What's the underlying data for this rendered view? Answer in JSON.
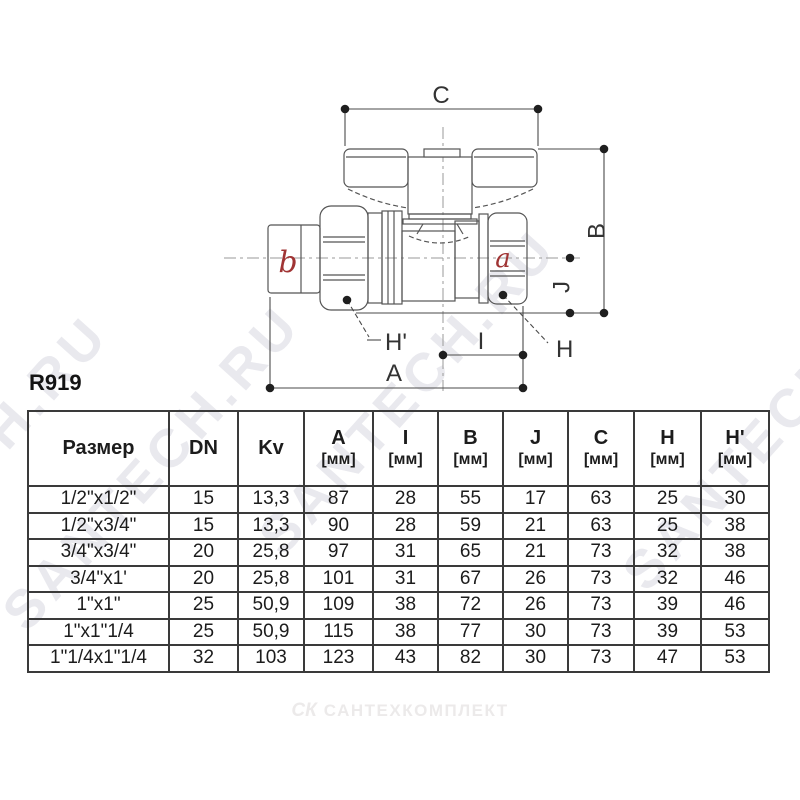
{
  "product_code": "R919",
  "diagram": {
    "dimension_labels": {
      "C": "C",
      "B": "B",
      "J": "J",
      "H": "H",
      "H_prime": "H'",
      "A": "A",
      "I": "I"
    },
    "port_labels": {
      "a": "a",
      "b": "b"
    },
    "colors": {
      "port_label": "#a03434",
      "line": "#4a4a4a",
      "dot": "#1f1f1f"
    }
  },
  "table": {
    "headers": [
      {
        "label": "Размер",
        "unit": ""
      },
      {
        "label": "DN",
        "unit": ""
      },
      {
        "label": "Kv",
        "unit": ""
      },
      {
        "label": "A",
        "unit": "[мм]"
      },
      {
        "label": "I",
        "unit": "[мм]"
      },
      {
        "label": "B",
        "unit": "[мм]"
      },
      {
        "label": "J",
        "unit": "[мм]"
      },
      {
        "label": "C",
        "unit": "[мм]"
      },
      {
        "label": "H",
        "unit": "[мм]"
      },
      {
        "label": "H'",
        "unit": "[мм]"
      }
    ],
    "rows": [
      [
        "1/2\"x1/2\"",
        "15",
        "13,3",
        "87",
        "28",
        "55",
        "17",
        "63",
        "25",
        "30"
      ],
      [
        "1/2\"x3/4\"",
        "15",
        "13,3",
        "90",
        "28",
        "59",
        "21",
        "63",
        "25",
        "38"
      ],
      [
        "3/4\"x3/4\"",
        "20",
        "25,8",
        "97",
        "31",
        "65",
        "21",
        "73",
        "32",
        "38"
      ],
      [
        "3/4\"x1'",
        "20",
        "25,8",
        "101",
        "31",
        "67",
        "26",
        "73",
        "32",
        "46"
      ],
      [
        "1\"x1\"",
        "25",
        "50,9",
        "109",
        "38",
        "72",
        "26",
        "73",
        "39",
        "46"
      ],
      [
        "1\"x1\"1/4",
        "25",
        "50,9",
        "115",
        "38",
        "77",
        "30",
        "73",
        "39",
        "53"
      ],
      [
        "1\"1/4x1\"1/4",
        "32",
        "103",
        "123",
        "43",
        "82",
        "30",
        "73",
        "47",
        "53"
      ]
    ]
  },
  "watermarks": {
    "diagonal_text": "SANTECH.RU",
    "footer_logo": "СК",
    "footer_text": "САНТЕХКОМПЛЕКТ"
  }
}
